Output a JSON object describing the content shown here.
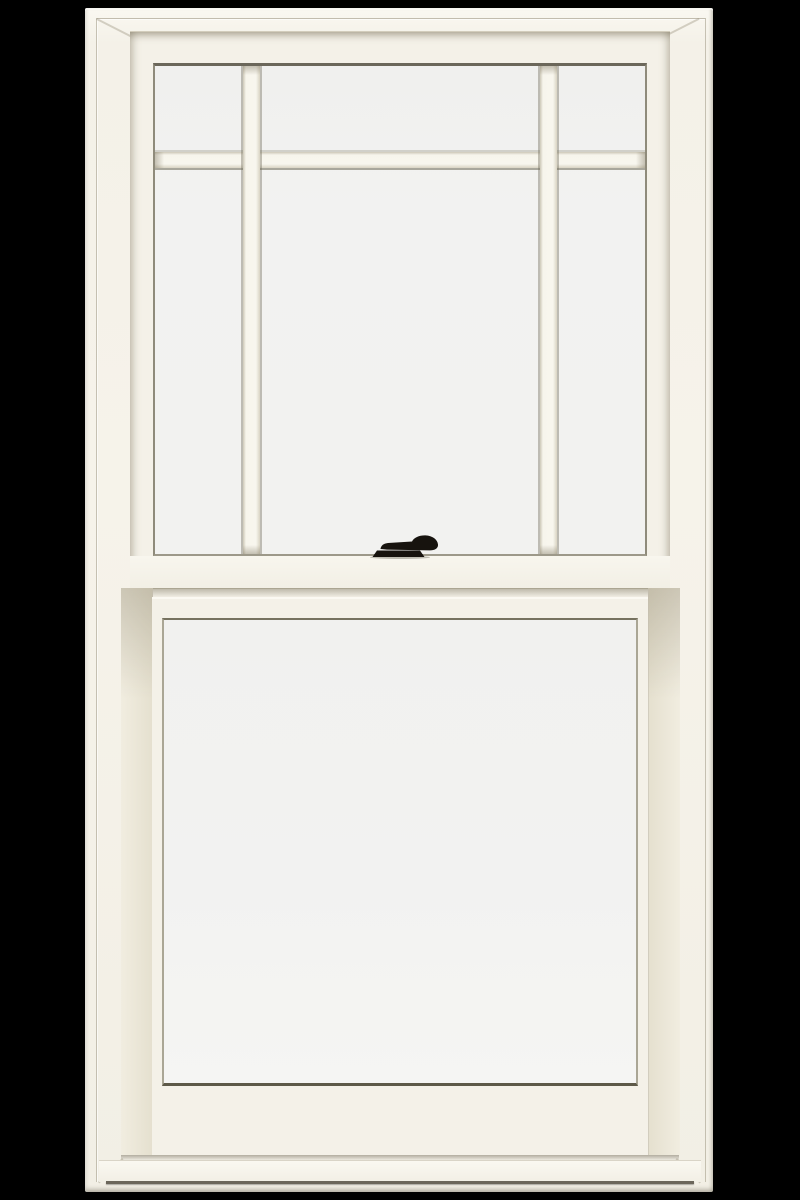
{
  "scene": {
    "type": "product-photo",
    "subject": "White double-hung window with prairie-style grille on the upper sash, clear single-lite lower sash, and a black cam-action sash lock centered on the check rail",
    "background_color": "#000000"
  },
  "colors": {
    "background": "#000000",
    "frame": "#f4f1e8",
    "frame_bright": "#faf8f1",
    "groove": "#b3ab99",
    "glass": "#f2f2f1",
    "glass_edge_dark": "#5d5948",
    "glass_edge_olive": "#6b675a",
    "glass_edge_mid": "#9d998a",
    "glass_edge_soft": "#aaa695",
    "grille_bar_edge": "#d9d4c3",
    "jamb_liner": "#e5e0cf",
    "sill_crease": "#6b665a",
    "lock": "#17130e"
  },
  "window": {
    "style": "double-hung",
    "finish": "white",
    "upper_sash": {
      "grille_pattern": "prairie",
      "lite_columns": 3,
      "lite_rows": 2,
      "lite_count": 6,
      "grille_bars": [
        "vertical-left",
        "vertical-right",
        "horizontal-top"
      ]
    },
    "lower_sash": {
      "grille_pattern": "none",
      "lite_count": 1
    },
    "hardware": [
      {
        "name": "sash-lock",
        "color": "black",
        "position": "center of check rail"
      }
    ]
  }
}
